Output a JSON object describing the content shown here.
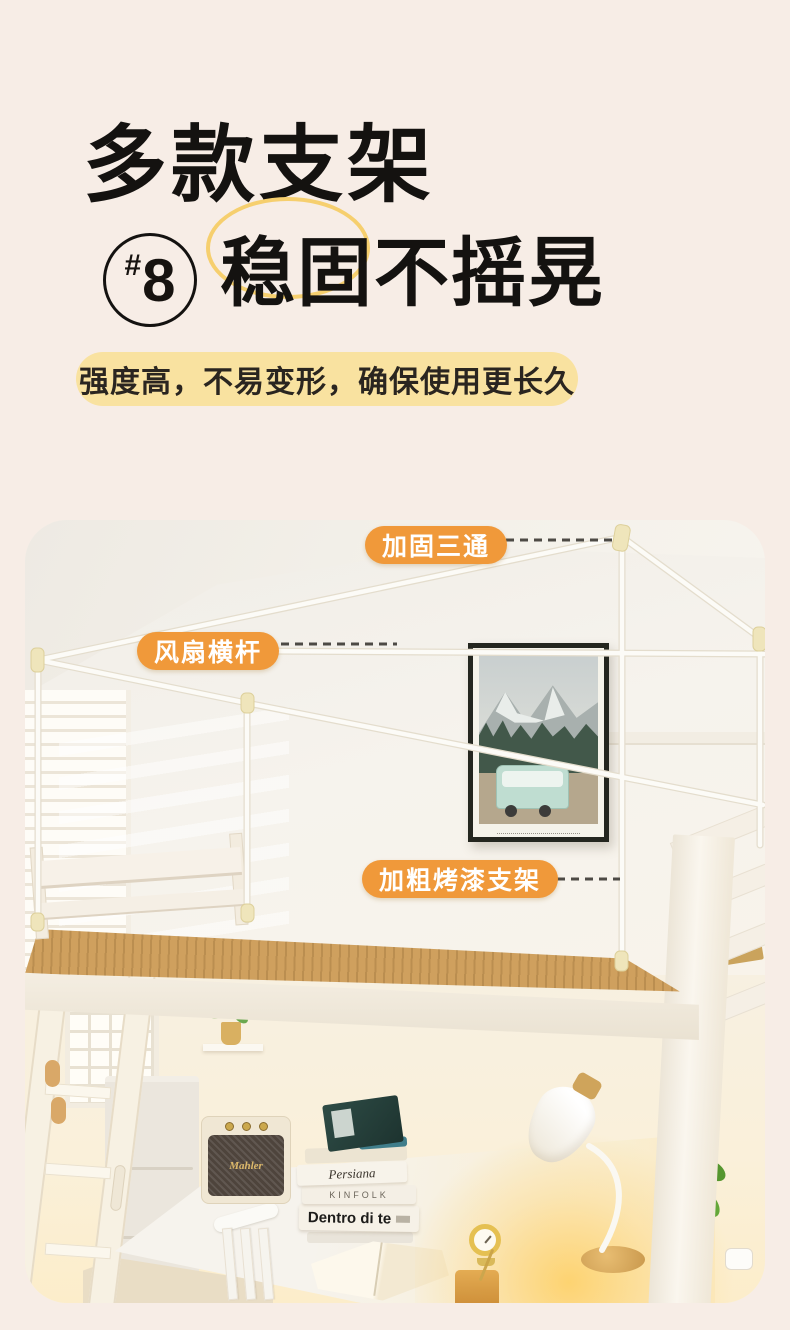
{
  "page": {
    "background": "#f7ede6"
  },
  "hero": {
    "title": "多款支架",
    "badge": {
      "hash": "#",
      "number": "8"
    },
    "subtitle": "稳固不摇晃",
    "highlight_color": "#f6cf6e",
    "tagline": "强度高，不易变形，确保使用更长久",
    "tagline_bg": "#f9e2a0"
  },
  "photo": {
    "callout_style": {
      "bg": "#f0993a",
      "text_color": "#ffffff",
      "dash_color": "#4d4a45"
    },
    "callouts": [
      {
        "text": "加固三通"
      },
      {
        "text": "风扇横杆"
      },
      {
        "text": "加粗烤漆支架"
      }
    ],
    "scene": {
      "speaker_logo": "Mahler",
      "books": [
        "Persiana",
        "KINFOLK",
        "Dentro di te"
      ]
    }
  }
}
